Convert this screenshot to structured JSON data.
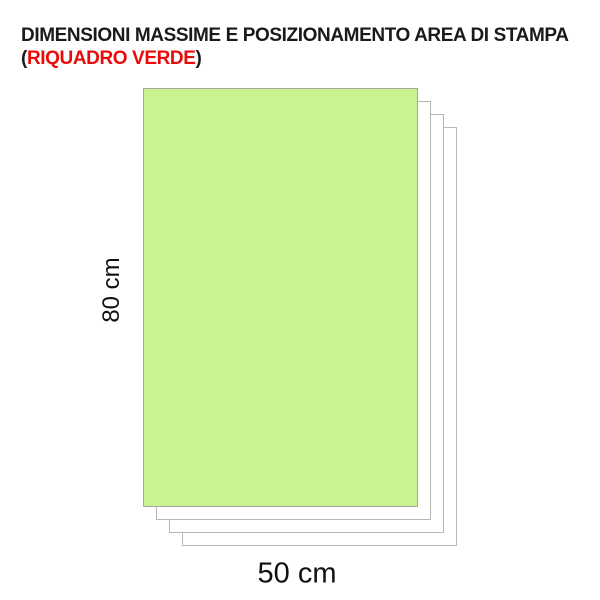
{
  "title": {
    "line1": "DIMENSIONI MASSIME E POSIZIONAMENTO AREA DI STAMPA",
    "line2_prefix": "(",
    "line2_highlight": "RIQUADRO VERDE",
    "line2_suffix": ")"
  },
  "diagram": {
    "height_label": "80 cm",
    "width_label": "50 cm",
    "sheet_count": 3,
    "colors": {
      "print_area_fill": "#caf28e",
      "print_area_border": "#a6a6a6",
      "sheet_fill": "#ffffff",
      "sheet_border": "#b7b7b7",
      "title_text": "#1a1a1a",
      "highlight_red": "#ea0a0a"
    }
  }
}
